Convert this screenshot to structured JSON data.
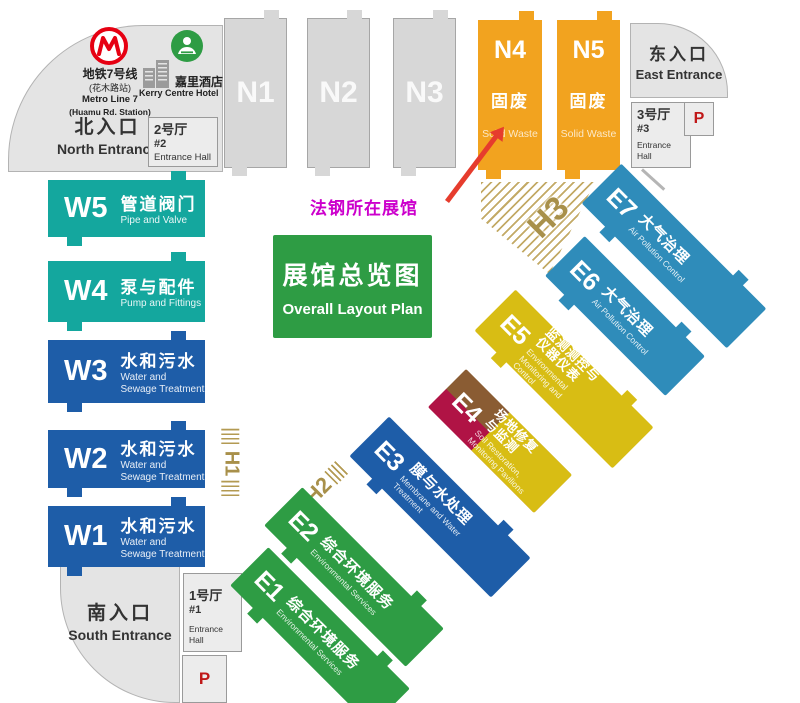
{
  "note": {
    "label": "法钢所在展馆"
  },
  "legend": {
    "title_cn": "展馆总览图",
    "title_en": "Overall Layout Plan"
  },
  "landmarks": {
    "metro": {
      "cn": "地铁7号线",
      "cn_sub": "(花木路站)",
      "en": "Metro Line 7",
      "en_sub": "(Huamu Rd. Station)"
    },
    "hotel": {
      "cn": "嘉里酒店",
      "en": "Kerry Centre Hotel"
    }
  },
  "entrances": {
    "north": {
      "cn": "北入口",
      "en": "North Entrance"
    },
    "east": {
      "cn": "东入口",
      "en": "East Entrance"
    },
    "south": {
      "cn": "南入口",
      "en": "South Entrance"
    }
  },
  "entrance_halls": {
    "no2": {
      "cn": "2号厅",
      "no": "#2",
      "en": "Entrance Hall"
    },
    "no3": {
      "cn": "3号厅",
      "no": "#3",
      "en": "Entrance Hall"
    },
    "no1": {
      "cn": "1号厅",
      "no": "#1",
      "en": "Entrance Hall"
    }
  },
  "parking": {
    "label": "P"
  },
  "halls": {
    "n": [
      {
        "id": "N1"
      },
      {
        "id": "N2"
      },
      {
        "id": "N3"
      }
    ],
    "n_theme": [
      {
        "id": "N4",
        "cn": "固废",
        "en": "Solid Waste"
      },
      {
        "id": "N5",
        "cn": "固废",
        "en": "Solid Waste"
      }
    ],
    "w": [
      {
        "id": "W5",
        "cn": "管道阀门",
        "en": "Pipe and Valve"
      },
      {
        "id": "W4",
        "cn": "泵与配件",
        "en": "Pump and Fittings"
      },
      {
        "id": "W3",
        "cn": "水和污水",
        "en": "Water and Sewage Treatment"
      },
      {
        "id": "W2",
        "cn": "水和污水",
        "en": "Water and Sewage Treatment"
      },
      {
        "id": "W1",
        "cn": "水和污水",
        "en": "Water and Sewage Treatment"
      }
    ],
    "e": [
      {
        "id": "E7",
        "cn": "大气治理",
        "en": "Air Pollution Control"
      },
      {
        "id": "E6",
        "cn": "大气治理",
        "en": "Air Pollution Control"
      },
      {
        "id": "E5",
        "cn": "监测测控与",
        "cn2": "仪器仪表",
        "en": "Environmental Monitoring and Control"
      },
      {
        "id": "E4",
        "cn": "场地修复",
        "cn2": "与监测",
        "en": "Soil Restoration, Monitoring Pavilions"
      },
      {
        "id": "E3",
        "cn": "膜与水处理",
        "en": "Membrane and Water Treatment"
      },
      {
        "id": "E2",
        "cn": "综合环境服务",
        "en": "Environmental Services"
      },
      {
        "id": "E1",
        "cn": "综合环境服务",
        "en": "Environmental Services"
      }
    ],
    "h_zones": [
      {
        "id": "H1"
      },
      {
        "id": "H2"
      },
      {
        "id": "H3"
      }
    ]
  },
  "colors": {
    "teal": "#14a79e",
    "w_blue": "#1e5da8",
    "orange": "#f2a31f",
    "steel_blue": "#2f8cba",
    "yellow": "#d8bd14",
    "crimson": "#b01345",
    "brown": "#8a5c33",
    "green": "#2e9c44",
    "gold": "#a8904a",
    "gray_hall": "#d7d7d7",
    "entrance_gray": "#e4e4e4",
    "note_magenta": "#cc00cc",
    "arrow_red": "#e63c2d",
    "metro_red": "#e60012",
    "parking_red": "#c01818"
  }
}
